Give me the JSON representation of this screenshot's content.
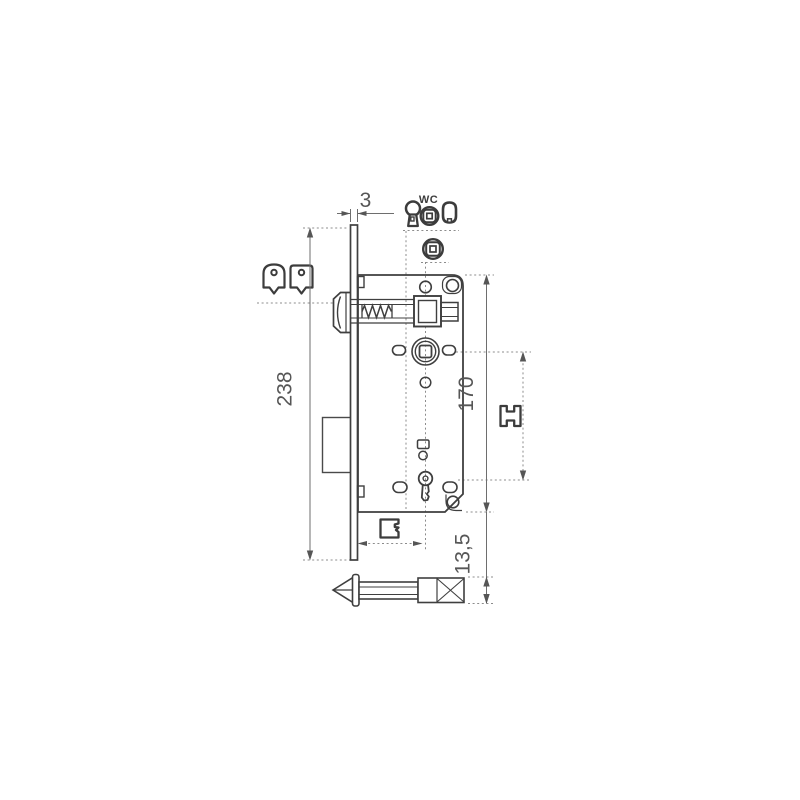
{
  "drawing": {
    "dimensions": {
      "faceplate_thickness": "3",
      "faceplate_height": "238",
      "case_height": "170",
      "spindle_square_length": "13,5"
    },
    "labels": {
      "wc_marking": "WC"
    },
    "icons": [
      "latch-profile-round-icon",
      "latch-profile-square-icon",
      "keyhole-icon",
      "wc-knob-icon",
      "oval-cylinder-icon",
      "follower-knob-icon",
      "spindle-square-icon",
      "key-bit-icon"
    ],
    "colors": {
      "part_line": "#3f3f3f",
      "dimension_line": "#6e6e6e",
      "text": "#565656",
      "background": "#ffffff"
    }
  }
}
